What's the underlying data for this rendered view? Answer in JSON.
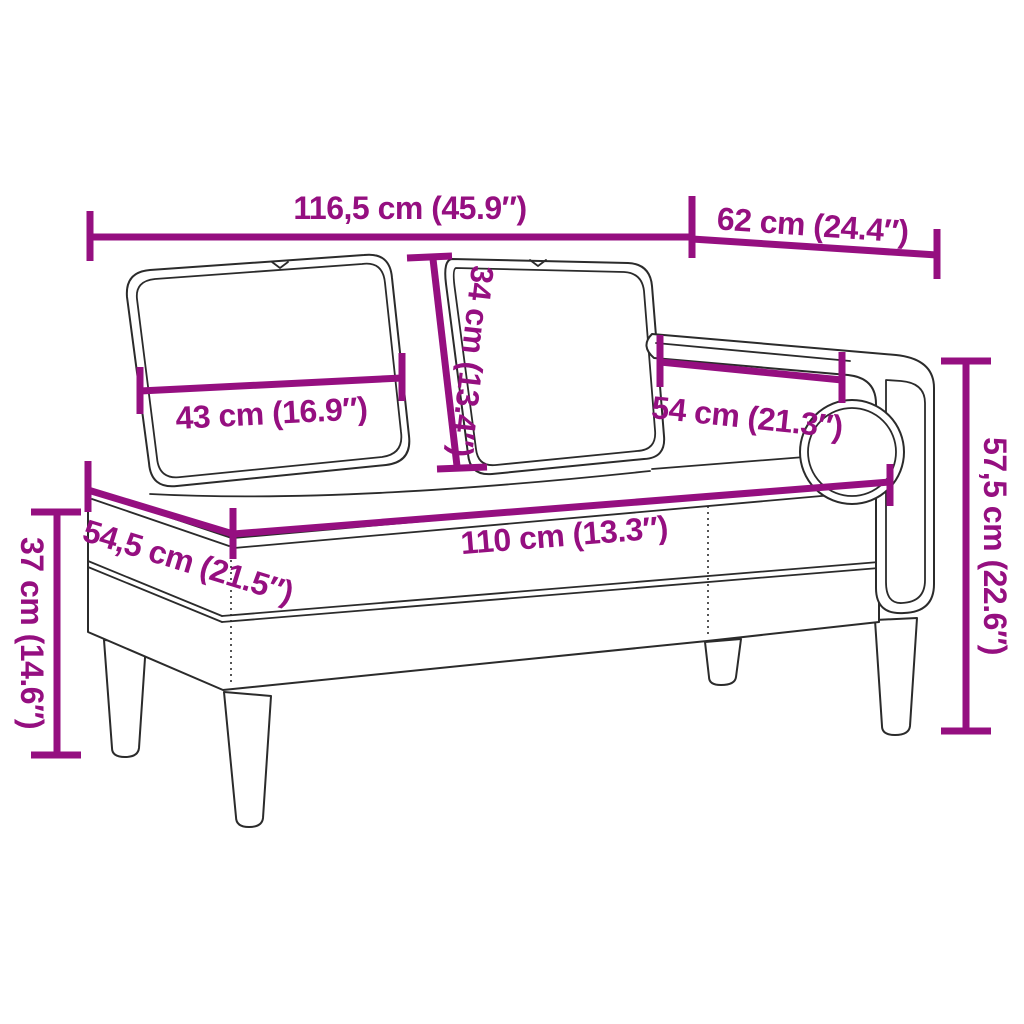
{
  "diagram": {
    "title": "Chaise longue dimension diagram",
    "background_color": "#ffffff",
    "outline_color": "#2b2b2b",
    "dimension_color": "#950f80"
  },
  "furniture": {
    "parts": [
      "left-back-cushion",
      "right-back-cushion",
      "armrest-rail",
      "armrest-side-panel",
      "bolster-cushion",
      "seat-base",
      "front-left-leg",
      "front-middle-leg",
      "back-leg",
      "right-leg"
    ]
  },
  "dimensions": {
    "total_width": {
      "label": "116,5 cm (45.9″)",
      "cm": "116,5",
      "inches": "45.9"
    },
    "top_depth": {
      "label": "62 cm (24.4″)",
      "cm": "62",
      "inches": "24.4"
    },
    "cushion_height": {
      "label": "34 cm (13.4″)",
      "cm": "34",
      "inches": "13.4"
    },
    "cushion_width": {
      "label": "43 cm (16.9″)",
      "cm": "43",
      "inches": "16.9"
    },
    "armrest_length": {
      "label": "54 cm (21.3″)",
      "cm": "54",
      "inches": "21.3"
    },
    "total_height": {
      "label": "57,5 cm (22.6″)",
      "cm": "57,5",
      "inches": "22.6"
    },
    "seat_length": {
      "label": "110 cm (13.3″)",
      "cm": "110",
      "inches": "13.3"
    },
    "seat_depth": {
      "label": "54,5 cm (21.5″)",
      "cm": "54,5",
      "inches": "21.5"
    },
    "leg_height": {
      "label": "37 cm (14.6″)",
      "cm": "37",
      "inches": "14.6"
    }
  }
}
